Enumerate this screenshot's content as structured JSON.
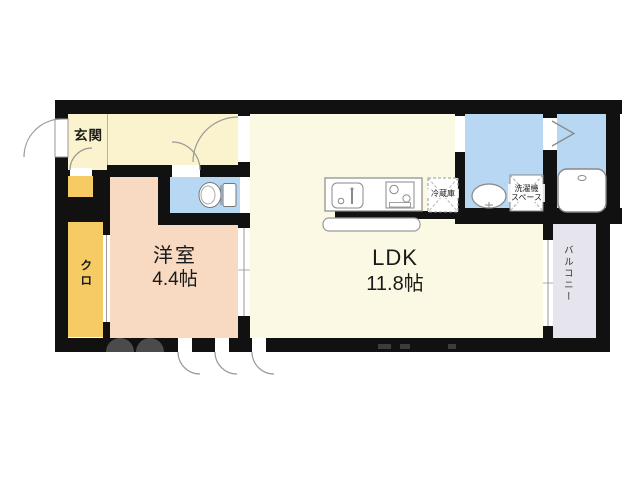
{
  "floorplan": {
    "genkan_label": "玄関",
    "west_room_name": "洋室",
    "west_room_size": "4.4帖",
    "ldk_name": "LDK",
    "ldk_size": "11.8帖",
    "closet_label": "クロ",
    "balcony_label": "バルコニー",
    "fridge_label": "冷蔵庫",
    "washer_line1": "洗濯機",
    "washer_line2": "スペース"
  },
  "colors": {
    "wall": "#111111",
    "entrance_hall": "#faf3cd",
    "ldk": "#fbf9e3",
    "west_room": "#f8d9c1",
    "closet": "#f6cb63",
    "water_rooms": "#b8d7f2",
    "balcony": "#e6e4ed",
    "fixture_outline": "#8a8a8a",
    "watermark": "#4b4b4b"
  }
}
